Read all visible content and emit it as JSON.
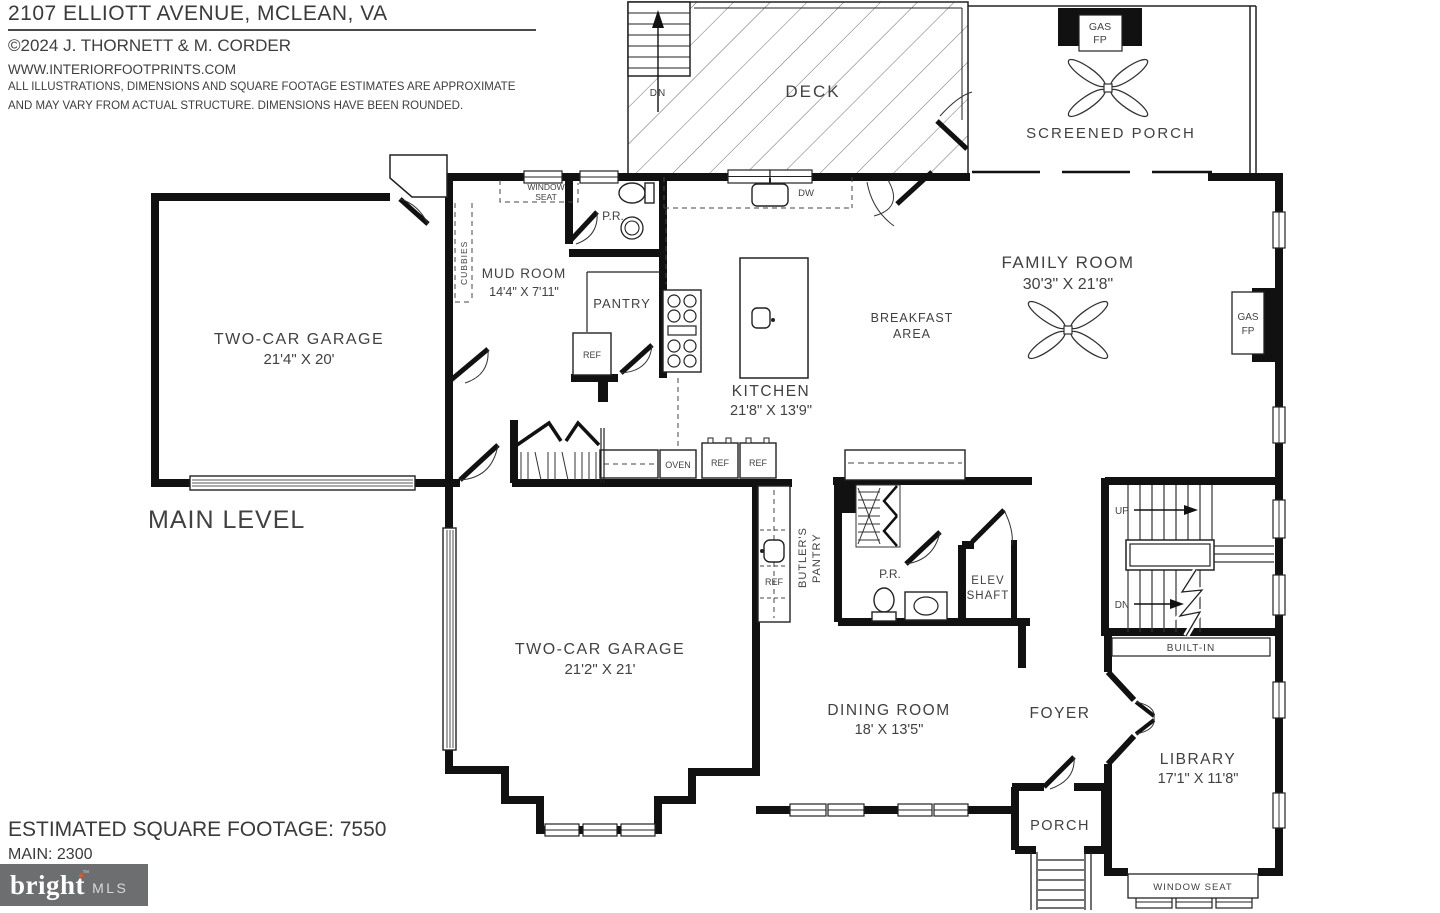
{
  "header": {
    "address": "2107 ELLIOTT AVENUE, MCLEAN, VA",
    "copyright": "©2024 J. THORNETT & M. CORDER",
    "website": "WWW.INTERIORFOOTPRINTS.COM",
    "disclaimer1": "ALL ILLUSTRATIONS, DIMENSIONS AND SQUARE FOOTAGE ESTIMATES ARE APPROXIMATE",
    "disclaimer2": "AND MAY VARY FROM ACTUAL STRUCTURE. DIMENSIONS HAVE BEEN ROUNDED."
  },
  "plan": {
    "level": "MAIN LEVEL",
    "deck": "DECK",
    "deck_stairs_dn": "DN",
    "screened_porch": "SCREENED PORCH",
    "gas_line": "GAS",
    "fp_line": "FP",
    "window_seat_line1": "WINDOW",
    "window_seat_line2": "SEAT",
    "cubbies": "CUBBIES",
    "mud_room_name": "MUD ROOM",
    "mud_room_dims": "14'4\" X 7'11\"",
    "powder_room": "P.R.",
    "pantry": "PANTRY",
    "ref": "REF",
    "dw": "DW",
    "oven": "OVEN",
    "kitchen_name": "KITCHEN",
    "kitchen_dims": "21'8\" X 13'9\"",
    "breakfast_line1": "BREAKFAST",
    "breakfast_line2": "AREA",
    "family_room_name": "FAMILY ROOM",
    "family_room_dims": "30'3\" X 21'8\"",
    "garage_upper_name": "TWO-CAR GARAGE",
    "garage_upper_dims": "21'4\" X 20'",
    "garage_lower_name": "TWO-CAR GARAGE",
    "garage_lower_dims": "21'2\" X 21'",
    "butlers_pantry_line1": "BUTLER'S",
    "butlers_pantry_line2": "PANTRY",
    "elev_line1": "ELEV",
    "elev_line2": "SHAFT",
    "stairs_up": "UP",
    "stairs_dn": "DN",
    "built_in": "BUILT-IN",
    "dining_room_name": "DINING ROOM",
    "dining_room_dims": "18' X 13'5\"",
    "foyer": "FOYER",
    "library_name": "LIBRARY",
    "library_dims": "17'1\" X 11'8\"",
    "porch": "PORCH",
    "window_seat_bottom": "WINDOW SEAT"
  },
  "footer": {
    "estimated": "ESTIMATED SQUARE FOOTAGE: 7550",
    "main": "MAIN: 2300"
  },
  "logo": {
    "brand": "bright",
    "star": "✦",
    "tm": "™",
    "suffix": "MLS",
    "bg_color": "#6d6e70",
    "star_color": "#e1552e"
  },
  "colors": {
    "wall": "#111111",
    "text": "#414141",
    "background": "#ffffff"
  }
}
